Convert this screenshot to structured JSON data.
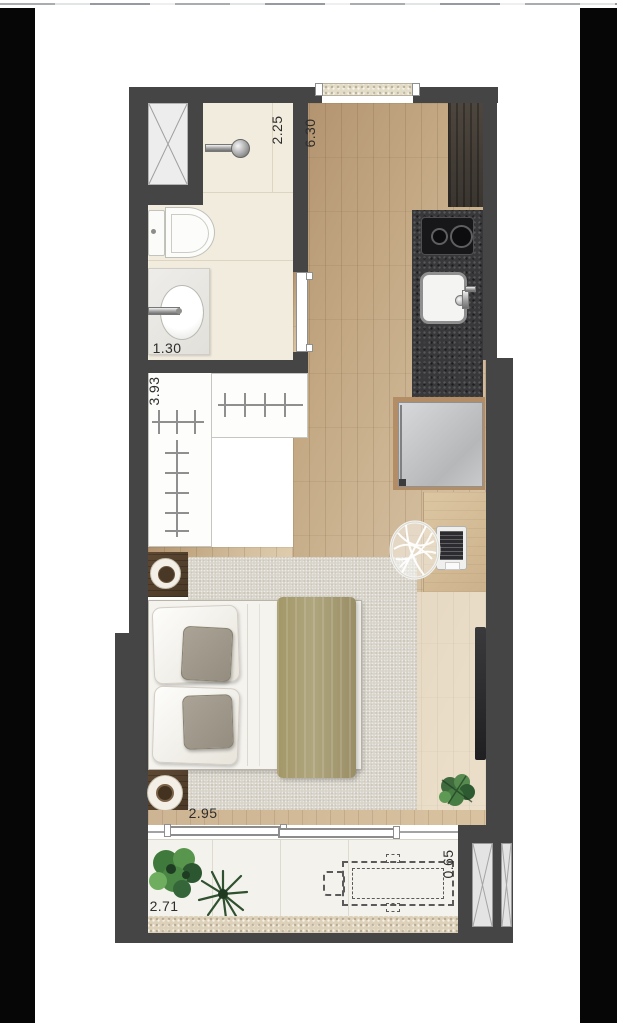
{
  "page": {
    "background_color": "#ffffff",
    "side_bars_color": "#060606",
    "top_strip_color": "#ffffff"
  },
  "floor_plan": {
    "type": "studio-apartment-floor-plan-top-view",
    "wall_color": "#454545",
    "wood_floor_color": "#cfb897",
    "bathroom_floor_color": "#f2ecdf",
    "rug_color": "#d7d3c9",
    "blanket_color": "#a89d74",
    "counter_color": "#38383a",
    "balcony_floor_color": "#f4f2ec",
    "dimensions": [
      {
        "name": "shower-width",
        "value": "2.25",
        "orientation": "vertical"
      },
      {
        "name": "living-room-length",
        "value": "6.30",
        "orientation": "vertical"
      },
      {
        "name": "bathroom-length",
        "value": "1.30",
        "orientation": "horizontal"
      },
      {
        "name": "closet-wall-length",
        "value": "3.93",
        "orientation": "vertical"
      },
      {
        "name": "bedroom-width",
        "value": "2.95",
        "orientation": "horizontal"
      },
      {
        "name": "balcony-length",
        "value": "2.71",
        "orientation": "horizontal"
      },
      {
        "name": "balcony-depth",
        "value": "0.65",
        "orientation": "vertical"
      }
    ],
    "rooms": [
      "bathroom",
      "shower",
      "closet",
      "kitchen",
      "living-bedroom",
      "balcony"
    ],
    "furniture": [
      "service-shaft",
      "shower-mixer",
      "toilet",
      "vanity-sink",
      "entry-sill",
      "wardrobe-cabinet",
      "kitchen-counter",
      "cooktop",
      "kitchen-sink",
      "fridge",
      "clothes-rails",
      "round-side-tables",
      "double-bed",
      "gray-pillows",
      "olive-blanket",
      "area-rug",
      "desk",
      "laptop",
      "wire-chair",
      "wall-tv",
      "monstera-plant",
      "balcony-plants",
      "sliding-glass-door",
      "dashed-future-table",
      "louver-shafts"
    ]
  }
}
